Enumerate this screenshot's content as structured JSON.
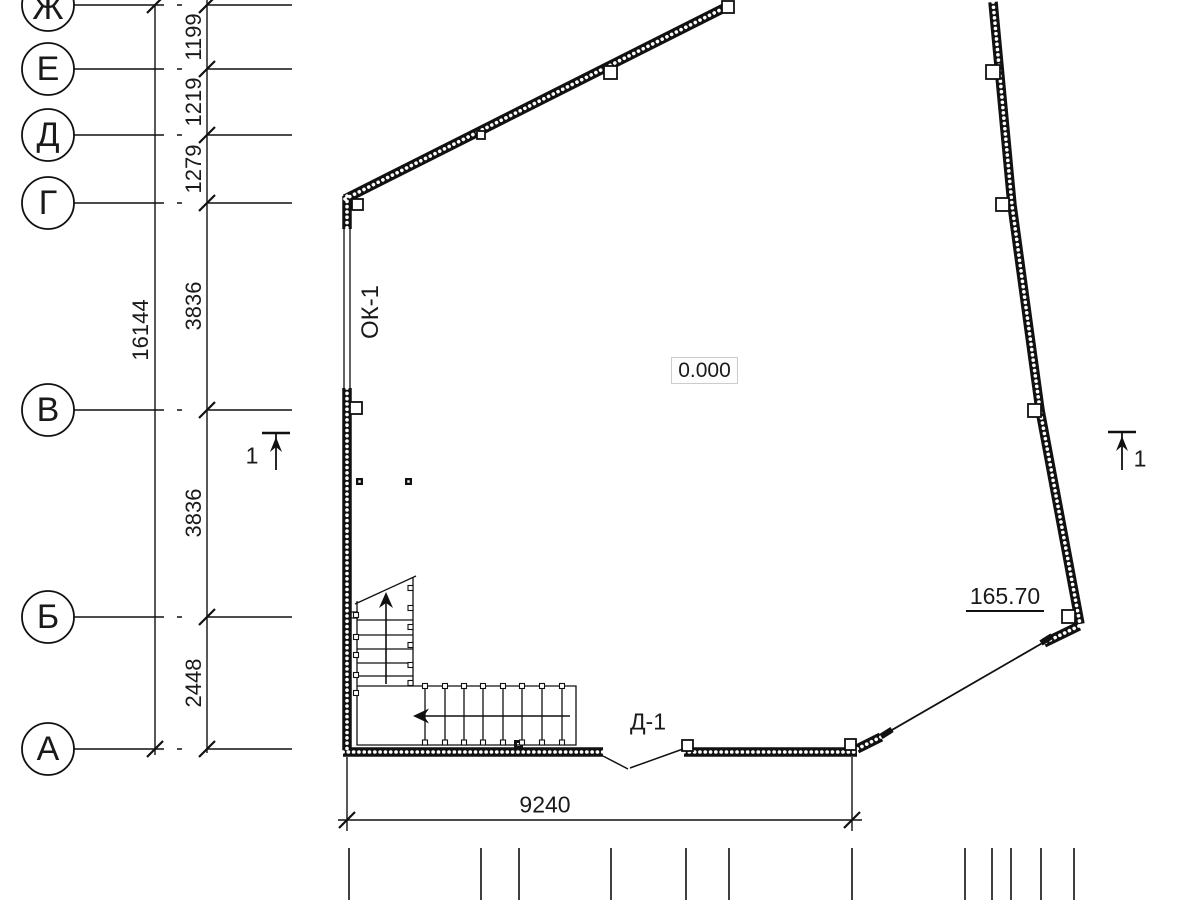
{
  "plan": {
    "grid_letters": [
      "Ж",
      "Е",
      "Д",
      "Г",
      "В",
      "Б",
      "А"
    ],
    "axis_dimensions": [
      "1199",
      "1219",
      "1279",
      "3836",
      "3836",
      "2448"
    ],
    "overall_dimension": "16144",
    "bottom_dimension": "9240",
    "window_mark": "ОК-1",
    "door_mark": "Д-1",
    "floor_level": "0.000",
    "elevation": "165.70",
    "section_number": "1",
    "colors": {
      "ink": "#111111",
      "level_box_border": "#cccccc"
    }
  }
}
